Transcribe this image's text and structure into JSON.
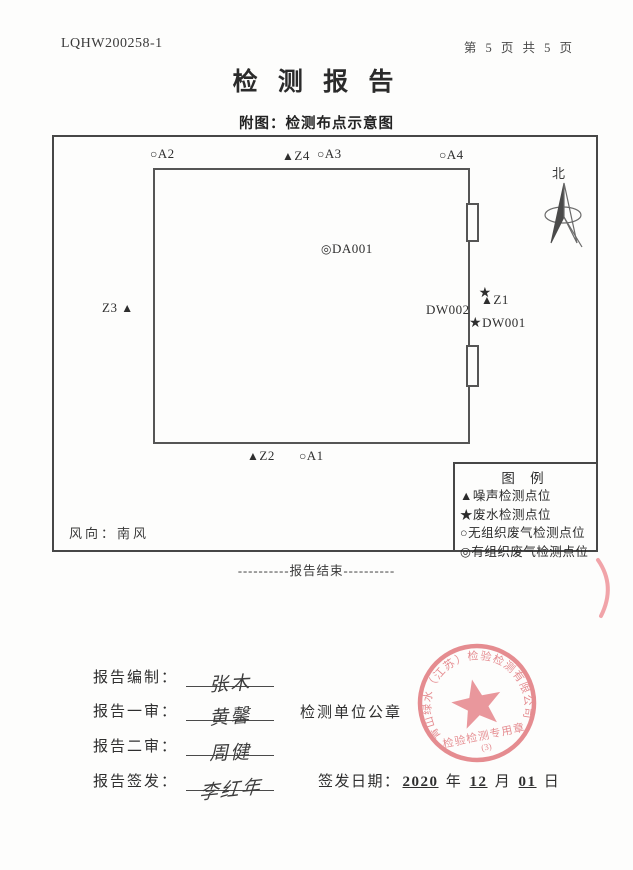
{
  "header": {
    "report_no": "LQHW200258-1",
    "page_info": "第 5 页 共 5 页"
  },
  "title": "检 测 报 告",
  "subtitle": "附图：检测布点示意图",
  "diagram": {
    "north_label": "北",
    "wind": "风向：南风",
    "points": [
      {
        "symbol": "○",
        "label": "A2"
      },
      {
        "symbol": "▲",
        "label": "Z4"
      },
      {
        "symbol": "○",
        "label": "A3"
      },
      {
        "symbol": "○",
        "label": "A4"
      },
      {
        "symbol": "◎",
        "label": "DA001"
      },
      {
        "symbol": "★",
        "label": "DW002"
      },
      {
        "symbol": "▲",
        "label": "Z1"
      },
      {
        "symbol": "★",
        "label": "DW001"
      },
      {
        "symbol": "▲",
        "label": "Z3"
      },
      {
        "symbol": "▲",
        "label": "Z2"
      },
      {
        "symbol": "○",
        "label": "A1"
      }
    ],
    "legend": {
      "title": "图  例",
      "items": [
        {
          "symbol": "▲",
          "label": "噪声检测点位"
        },
        {
          "symbol": "★",
          "label": "废水检测点位"
        },
        {
          "symbol": "○",
          "label": "无组织废气检测点位"
        },
        {
          "symbol": "◎",
          "label": "有组织废气检测点位"
        }
      ]
    }
  },
  "report_end": "----------报告结束----------",
  "signoff": {
    "rows": [
      {
        "label": "报告编制：",
        "signature": "张木"
      },
      {
        "label": "报告一审：",
        "signature": "黄馨"
      },
      {
        "label": "报告二审：",
        "signature": "周健"
      },
      {
        "label": "报告签发：",
        "signature": "李红年"
      }
    ],
    "seal_caption": "检测单位公章",
    "issue_date": {
      "label": "签发日期：",
      "year": "2020",
      "year_unit": "年",
      "month": "12",
      "month_unit": "月",
      "day": "01",
      "day_unit": "日"
    }
  },
  "seal": {
    "company": "青山绿水（江苏）检验检测有限公司",
    "type_text": "检验检测专用章",
    "number": "(3)",
    "color": "#e27d82"
  }
}
